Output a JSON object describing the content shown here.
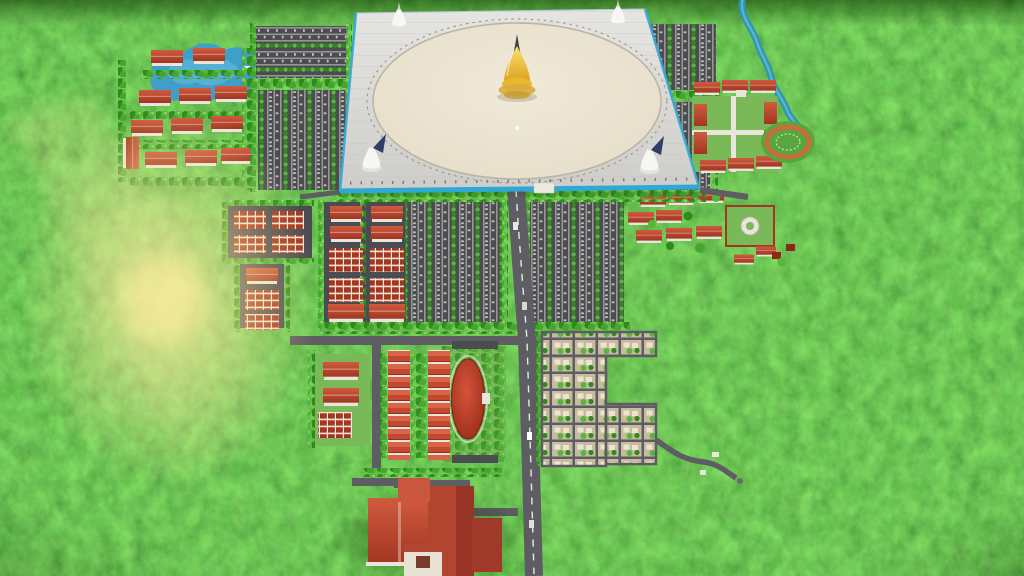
{
  "scene": {
    "kind": "aerial-3d-master-plan-render",
    "subject": "pagoda-complex-in-forest"
  },
  "colors": {
    "forest_base": "#478f1e",
    "tree_dark": "#2f8a1c",
    "tree_mid": "#46a52f",
    "tree_light": "#57b63e",
    "tree_highlight": "#8ed45f",
    "lake_blue": "#3f9fc9",
    "lake_light": "#74c4e2",
    "river_teal": "#2f93b4",
    "river_light": "#63bcd6",
    "platform_light": "#e6e5e1",
    "platform_dark": "#cecdc9",
    "plaza_light": "#f1ead8",
    "plaza_dark": "#e3dcc8",
    "trim_blue": "#2fa8d6",
    "gold_light": "#fadf6e",
    "gold_dark": "#dd9f1a",
    "gold_base": "#d9ad3d",
    "spire_dark": "#3d4248",
    "stupa_white": "#f7f7f4",
    "stupa_base": "#e4e4df",
    "flag_navy": "#2e3f63",
    "roof_light": "#d05a3e",
    "roof_dark": "#a13621",
    "roof_deep": "#8f2617",
    "wall_white": "#eae5da",
    "pavement_dark": "#4b4b52",
    "lane_gray": "#96968f",
    "car_gray": "#c6c6bd",
    "road_gray": "#5d5d63",
    "road_dash": "#e8e8e4",
    "grass_green": "#79b957",
    "track_ring": "#cd6a3a",
    "track_infield": "#5aa63e",
    "plot_tan": "#c6bb9e",
    "plot_road": "#5c5c62",
    "plot_house": "#ece4cf",
    "strip_red": "#c2492f",
    "strip_highlight": "#d8654a",
    "strip_seam": "#8c2e1e",
    "oval_red": "#d5543a",
    "glow_yellow": "#ffe9a0",
    "shadow_green": "#0c2d05"
  }
}
